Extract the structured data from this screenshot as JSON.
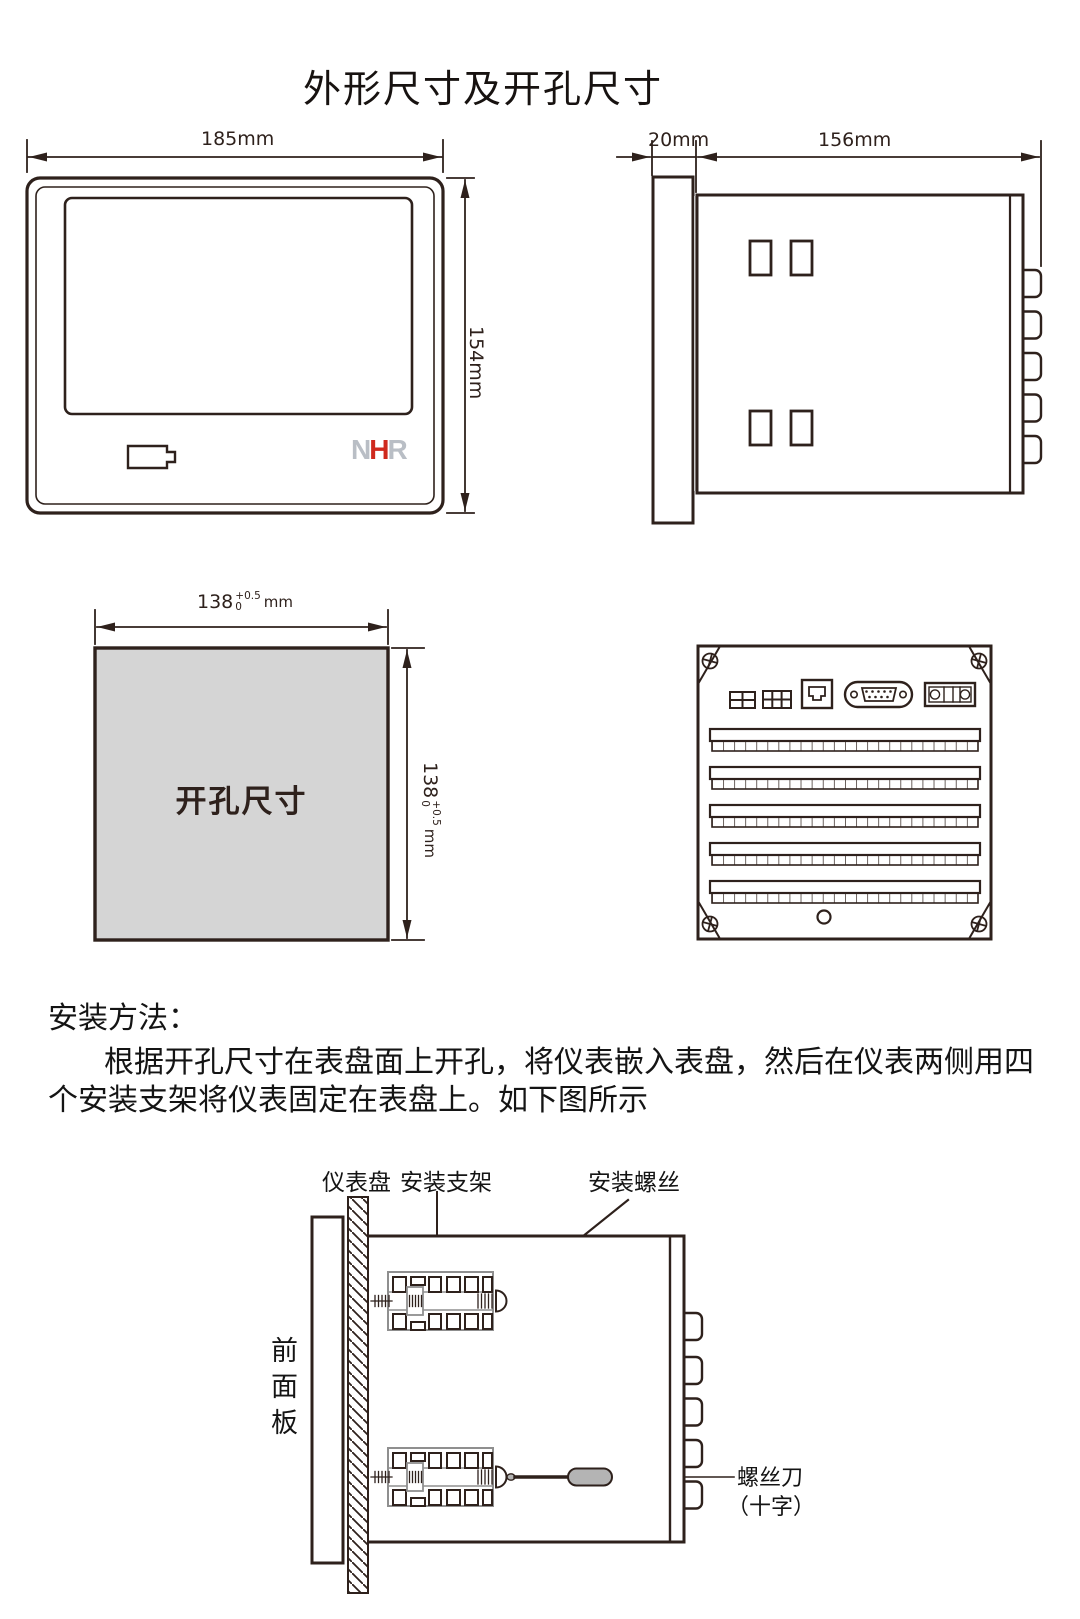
{
  "page": {
    "title": "外形尺寸及开孔尺寸"
  },
  "colors": {
    "line": "#2e211c",
    "cutout_fill": "#d5d5d5",
    "logo_gray": "#b9bec5",
    "logo_red": "#cf291d",
    "screwdriver_gray": "#b4b4b4"
  },
  "front_view": {
    "width_label": "185mm",
    "height_label": "154mm",
    "logo": {
      "n": "N",
      "h": "H",
      "r": "R"
    }
  },
  "side_view": {
    "depth_front_label": "20mm",
    "depth_body_label": "156mm"
  },
  "cutout_view": {
    "label": "开孔尺寸",
    "dim_value": "138",
    "dim_tol_plus": "+0.5",
    "dim_tol_minus": "0",
    "dim_unit": "mm"
  },
  "install": {
    "heading": "安装方法：",
    "para_line1": "根据开孔尺寸在表盘面上开孔，将仪表嵌入表盘，然后在仪表两侧用四",
    "para_line2": "个安装支架将仪表固定在表盘上。如下图所示",
    "labels": {
      "panel": "仪表盘",
      "bracket": "安装支架",
      "screw": "安装螺丝",
      "front_panel": "前面板",
      "screwdriver_line1": "螺丝刀",
      "screwdriver_line2": "（十字）"
    }
  }
}
